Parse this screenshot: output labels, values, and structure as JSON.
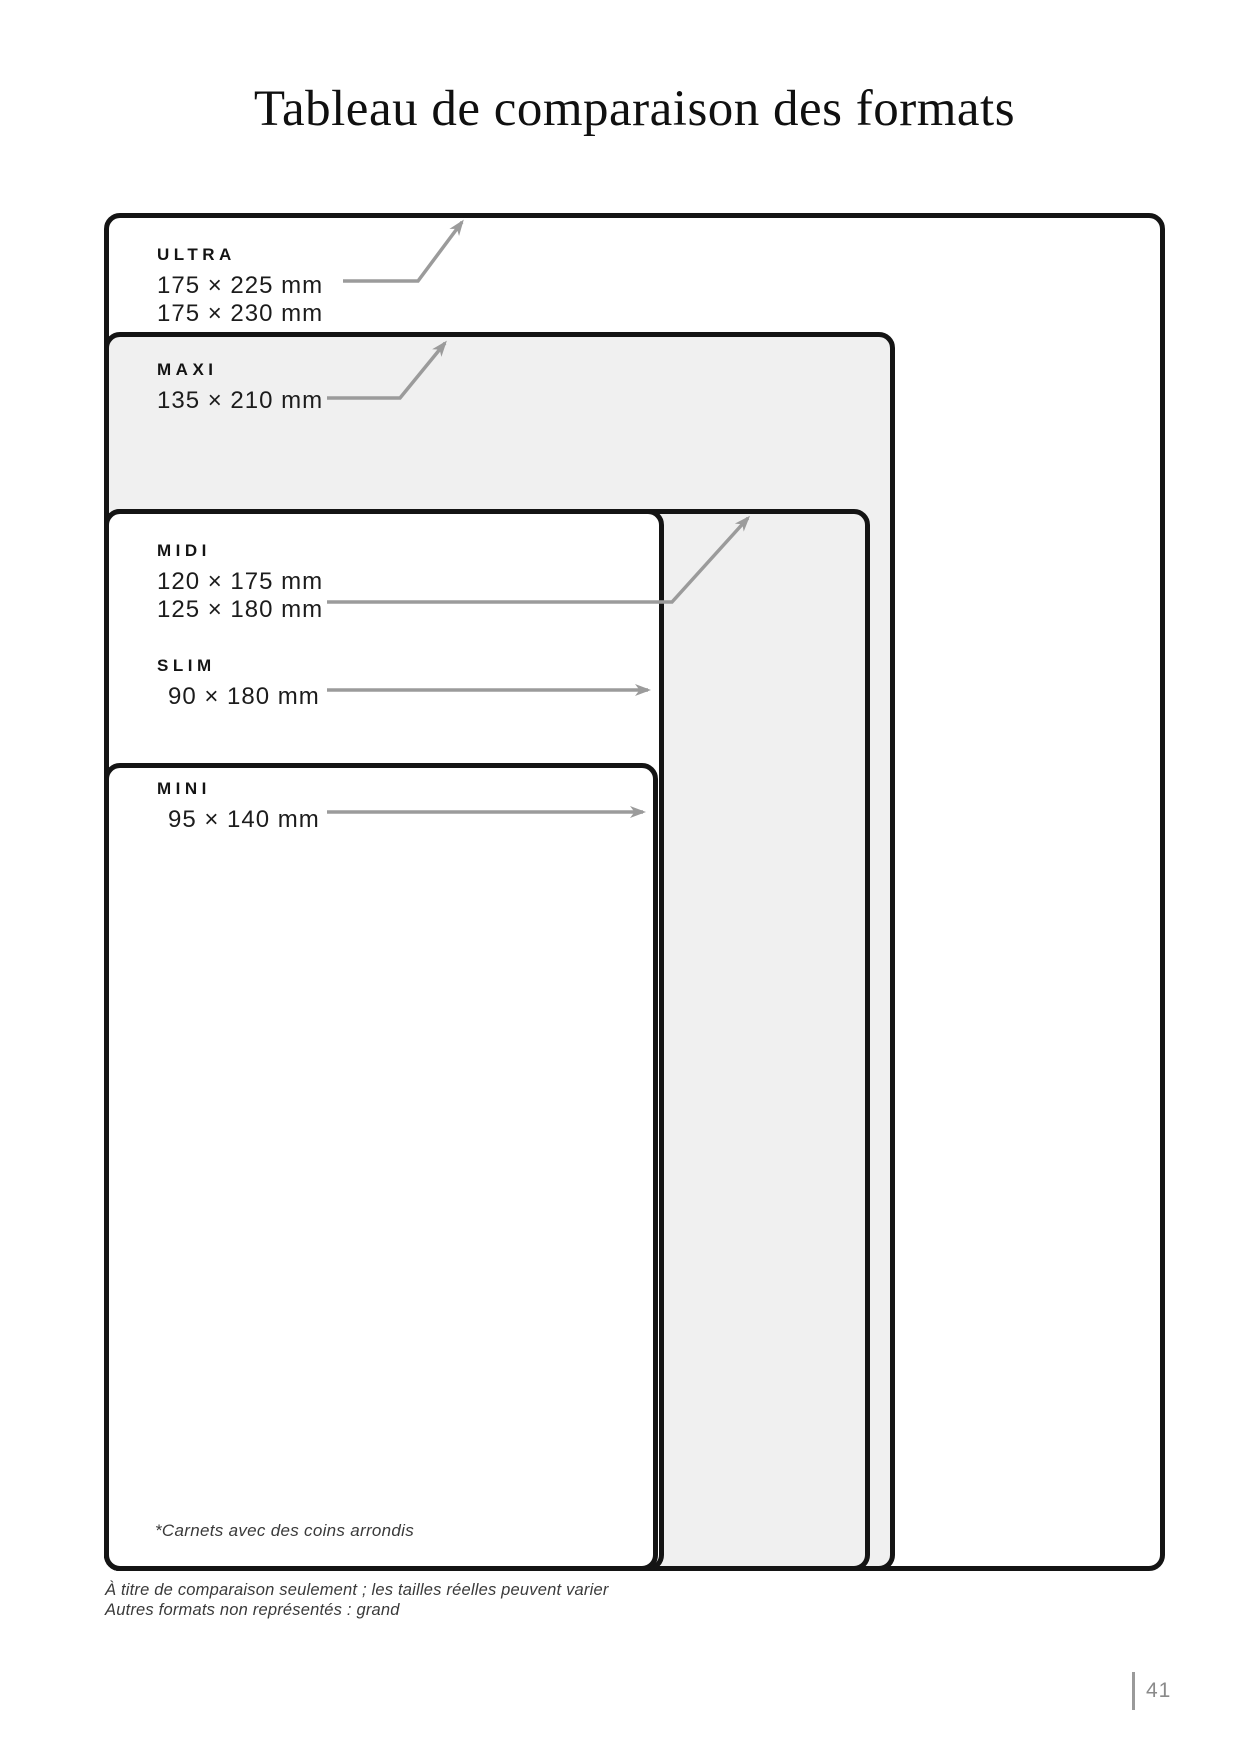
{
  "page": {
    "title": "Tableau de comparaison des formats",
    "page_number": "41"
  },
  "formats": [
    {
      "name": "ULTRA",
      "dims": [
        "175 × 225 mm",
        "175 × 230 mm"
      ]
    },
    {
      "name": "MAXI",
      "dims": [
        "135 × 210 mm"
      ]
    },
    {
      "name": "MIDI",
      "dims": [
        "120 × 175 mm",
        "125 × 180 mm"
      ]
    },
    {
      "name": "SLIM",
      "dims": [
        "90 × 180 mm"
      ]
    },
    {
      "name": "MINI",
      "dims": [
        "95 × 140 mm"
      ]
    }
  ],
  "footnotes": {
    "inside_box": "*Carnets avec des coins arrondis",
    "below_line1": "À titre de comparaison seulement ; les tailles réelles peuvent varier",
    "below_line2": "Autres formats non représentés : grand"
  },
  "colors": {
    "box_border": "#141414",
    "box_fill_gray": "#f0f0f0",
    "box_fill_white": "#ffffff",
    "arrow_gray": "#9b9b9b",
    "page_number_gray": "#8a8a8a"
  }
}
